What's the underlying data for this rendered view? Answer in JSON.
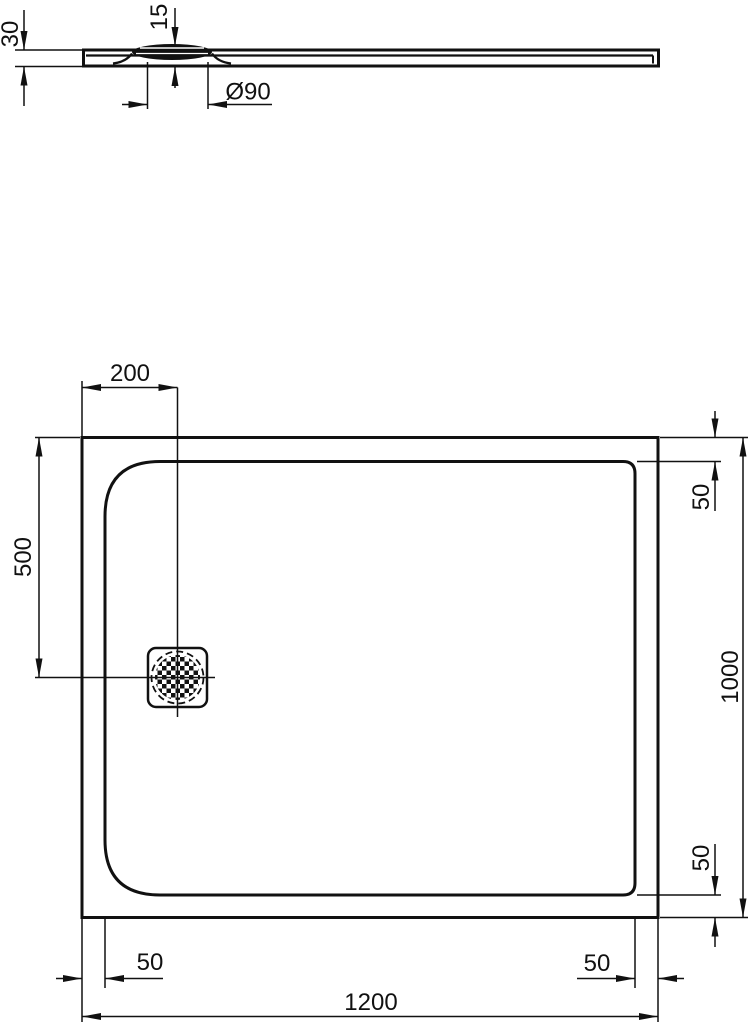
{
  "section_view": {
    "tray_thickness_label": "30",
    "drain_height_label": "15",
    "drain_diameter_label": "Ø90"
  },
  "plan_view": {
    "drain_offset_left_label": "200",
    "drain_offset_top_label": "500",
    "right_top_inset_label": "50",
    "overall_depth_label": "1000",
    "right_bottom_inset_label": "50",
    "bottom_left_inset_label": "50",
    "bottom_right_inset_label": "50",
    "overall_width_label": "1200"
  },
  "colors": {
    "line": "#111111",
    "background": "#ffffff"
  }
}
